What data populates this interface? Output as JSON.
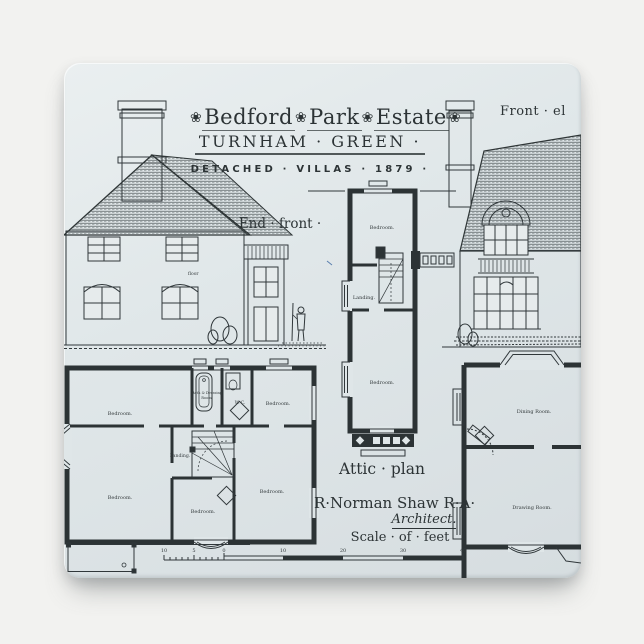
{
  "colors": {
    "background": "#f2f2f0",
    "magnet_face": "#dfe6e8",
    "ink": "#2c3335"
  },
  "title": {
    "rosette": "❀",
    "word1": "Bedford",
    "word2": "Park",
    "word3": "Estate",
    "line2": "TURNHAM · GREEN ·",
    "line3": "DETACHED · VILLAS · 1879 ·"
  },
  "labels": {
    "front_elevation": "Front · el",
    "end_front": "End · front ·",
    "attic_plan": "Attic · plan",
    "architect_name": "R·Norman Shaw R·A·",
    "architect_title": "Architect.",
    "scale": "Scale · of · feet",
    "floor_note": "floor"
  },
  "attic_plan": {
    "bedroom_top": "Bedroom.",
    "landing": "Landing.",
    "bedroom_bottom": "Bedroom."
  },
  "first_floor_plan": {
    "bedroom_tl": "Bedroom.",
    "bath_line1": "Bath & Dressing",
    "bath_line2": "Room.",
    "wc": "W. C.",
    "bedroom_tr": "Bedroom.",
    "landing": "Landing.",
    "bedroom_bl": "Bedroom.",
    "bedroom_bc": "Bedroom.",
    "bedroom_br": "Bedroom."
  },
  "ground_floor_plan": {
    "dining": "Dining Room.",
    "drawing": "Drawing Room."
  },
  "scale_bar": {
    "n0": "10",
    "n1": "5",
    "n2": "0",
    "n3": "10",
    "n4": "20",
    "n5": "30",
    "n6": "40"
  }
}
